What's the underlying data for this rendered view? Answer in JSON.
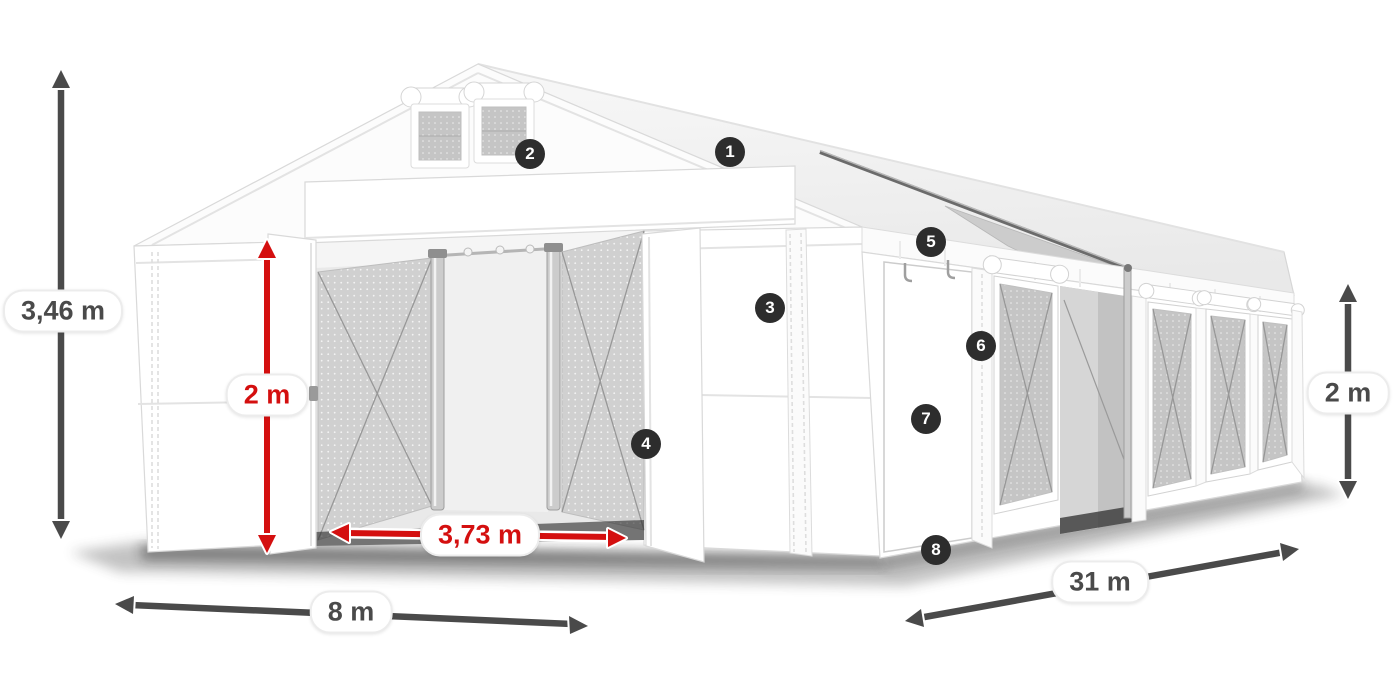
{
  "diagram": {
    "badges": [
      {
        "number": "1"
      },
      {
        "number": "2"
      },
      {
        "number": "3"
      },
      {
        "number": "4"
      },
      {
        "number": "5"
      },
      {
        "number": "6"
      },
      {
        "number": "7"
      },
      {
        "number": "8"
      }
    ],
    "dimensions": {
      "total_height": "3,46 m",
      "door_height": "2 m",
      "door_width": "3,73 m",
      "front_width": "8 m",
      "length": "31 m",
      "side_wall_height": "2 m"
    },
    "colors": {
      "dimension_red": "#d40f0f",
      "dimension_dark": "#4a4a4a",
      "badge_background": "#2d2d2d",
      "badge_text": "#ffffff"
    }
  }
}
